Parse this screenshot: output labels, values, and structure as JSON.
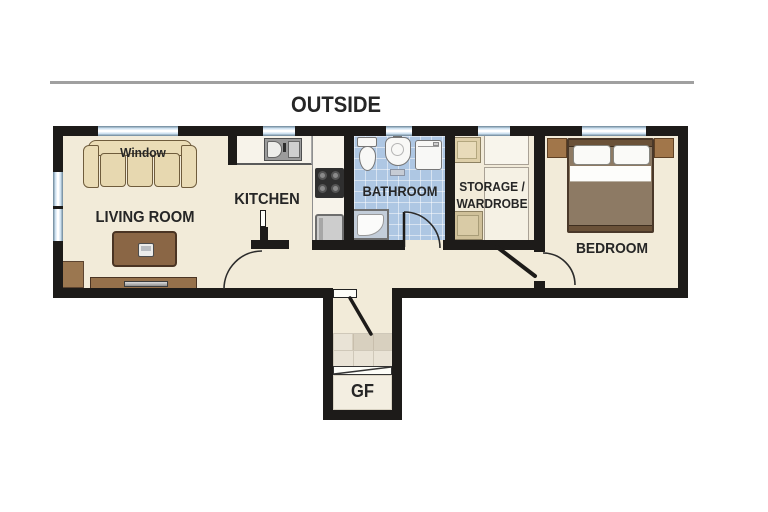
{
  "header": {
    "outside_label": "OUTSIDE"
  },
  "rooms": {
    "living_room": {
      "label": "LIVING ROOM",
      "window_label": "Window"
    },
    "kitchen": {
      "label": "KITCHEN"
    },
    "bathroom": {
      "label": "BATHROOM"
    },
    "storage": {
      "label": "STORAGE /\nWARDROBE"
    },
    "bedroom": {
      "label": "BEDROOM"
    },
    "entrance": {
      "label": "GF"
    }
  },
  "colors": {
    "wall": "#1d1b19",
    "floor": "#f2ebd9",
    "bathroom_floor": "#aec7e3",
    "sofa": "#eadcb6",
    "wood_brown": "#8a6645",
    "bed_blanket": "#8d7a64",
    "window_glass": "#cfe2f1",
    "accent_line": "#a0a0a0"
  }
}
